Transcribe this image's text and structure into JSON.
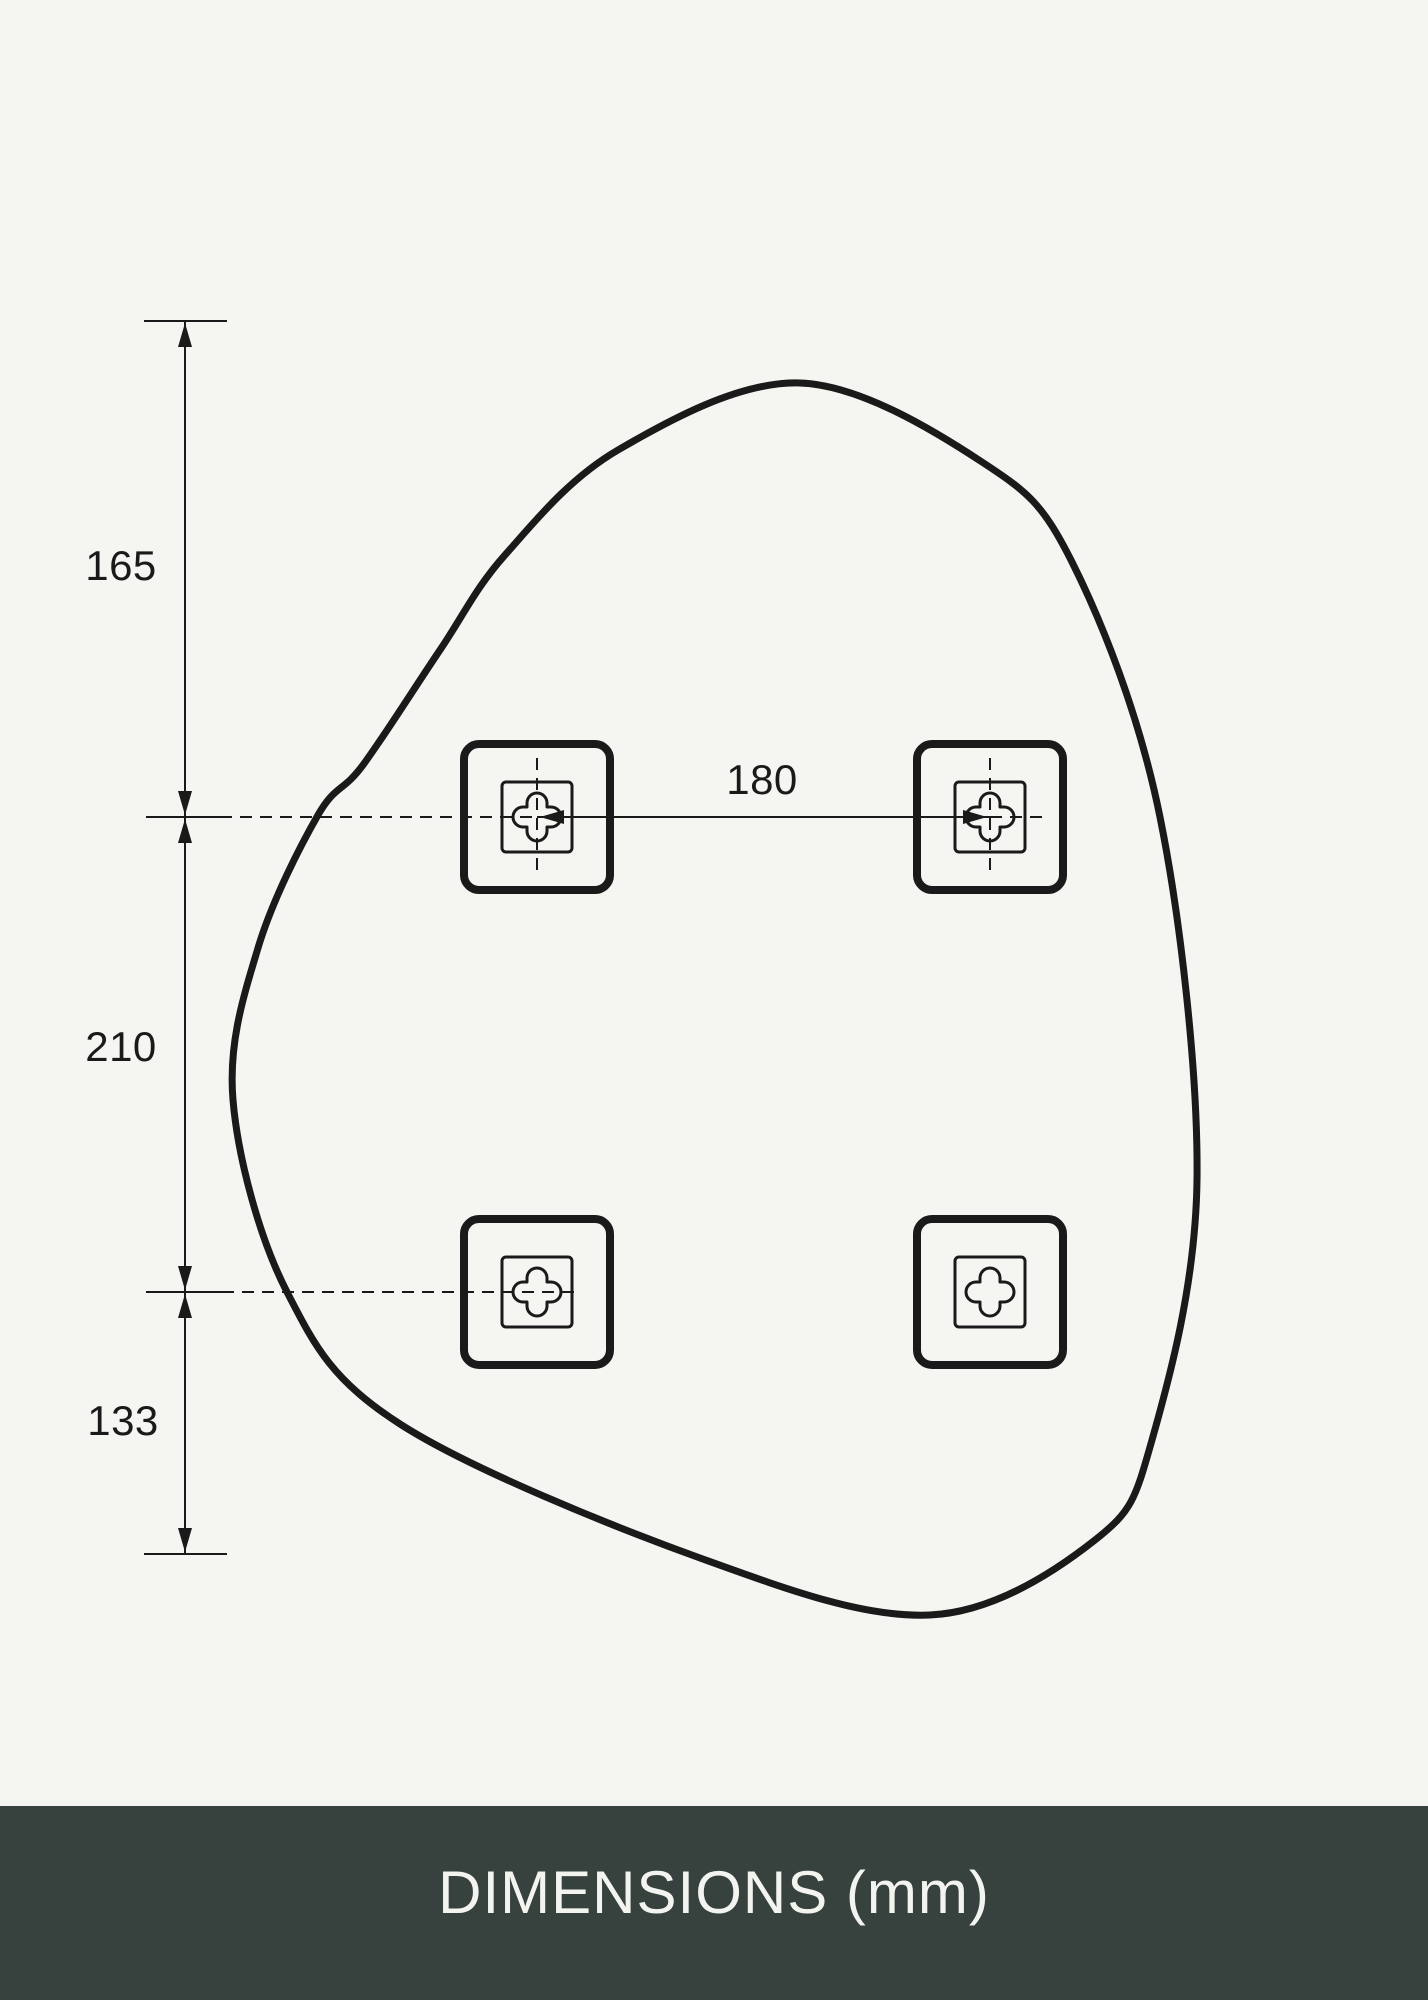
{
  "page": {
    "background": "#f5f6f2",
    "line_color": "#1a1a1a"
  },
  "footer": {
    "label": "DIMENSIONS (mm)",
    "background": "#37413e",
    "text_color": "#f3f4f0"
  },
  "diagram": {
    "unit": "mm",
    "vertical_dimensions": [
      {
        "value": "165",
        "from_y": 321,
        "to_y": 817,
        "label_x": 121,
        "label_y": 566
      },
      {
        "value": "210",
        "from_y": 817,
        "to_y": 1292,
        "label_x": 121,
        "label_y": 1047
      },
      {
        "value": "133",
        "from_y": 1292,
        "to_y": 1554,
        "label_x": 123,
        "label_y": 1421
      }
    ],
    "horizontal_dimension": {
      "value": "180",
      "from_x": 537,
      "to_x": 990,
      "y": 817,
      "label_x": 762,
      "label_y": 780
    },
    "geometry": {
      "dimension_line": {
        "x": 185,
        "y1": 321,
        "y2": 1554
      },
      "ticks": [
        {
          "y": 321,
          "x1": 144,
          "x2": 227
        },
        {
          "y": 817,
          "x1": 146,
          "x2": 222
        },
        {
          "y": 1292,
          "x1": 146,
          "x2": 222
        },
        {
          "y": 1554,
          "x1": 144,
          "x2": 227
        }
      ],
      "arrows": [
        {
          "x": 185,
          "y": 323,
          "dir": "up"
        },
        {
          "x": 185,
          "y": 815,
          "dir": "down"
        },
        {
          "x": 185,
          "y": 819,
          "dir": "up"
        },
        {
          "x": 185,
          "y": 1290,
          "dir": "down"
        },
        {
          "x": 185,
          "y": 1294,
          "dir": "up"
        },
        {
          "x": 185,
          "y": 1552,
          "dir": "down"
        },
        {
          "x": 540,
          "y": 817,
          "dir": "left"
        },
        {
          "x": 987,
          "y": 817,
          "dir": "right"
        }
      ],
      "guides": [
        {
          "type": "h",
          "y": 817,
          "x1": 220,
          "x2": 537
        },
        {
          "type": "h",
          "y": 817,
          "x1": 990,
          "x2": 1048
        },
        {
          "type": "h",
          "y": 1292,
          "x1": 222,
          "x2": 580
        },
        {
          "type": "v",
          "x": 537,
          "y1": 758,
          "y2": 876
        },
        {
          "type": "v",
          "x": 990,
          "y1": 758,
          "y2": 876
        }
      ],
      "mirror_outline_points": [
        [
          800,
          383
        ],
        [
          982,
          462
        ],
        [
          1072,
          562
        ],
        [
          1160,
          817
        ],
        [
          1197,
          1180
        ],
        [
          1152,
          1440
        ],
        [
          1095,
          1540
        ],
        [
          930,
          1615
        ],
        [
          700,
          1558
        ],
        [
          400,
          1424
        ],
        [
          287,
          1292
        ],
        [
          233,
          1100
        ],
        [
          258,
          948
        ],
        [
          318,
          815
        ],
        [
          363,
          765
        ],
        [
          440,
          650
        ],
        [
          505,
          555
        ],
        [
          618,
          450
        ]
      ],
      "mounts": {
        "centers": [
          [
            537,
            817
          ],
          [
            990,
            817
          ],
          [
            537,
            1292
          ],
          [
            990,
            1292
          ]
        ],
        "outer_size": 146,
        "outer_radius": 15,
        "outer_stroke": 8,
        "inner_size": 70,
        "inner_radius": 4,
        "inner_stroke": 3,
        "cross_half_length": 24,
        "cross_half_width": 10,
        "cross_stroke": 3
      },
      "stroke": {
        "outline": 7,
        "thin": 2,
        "dash": "12 8"
      }
    }
  }
}
